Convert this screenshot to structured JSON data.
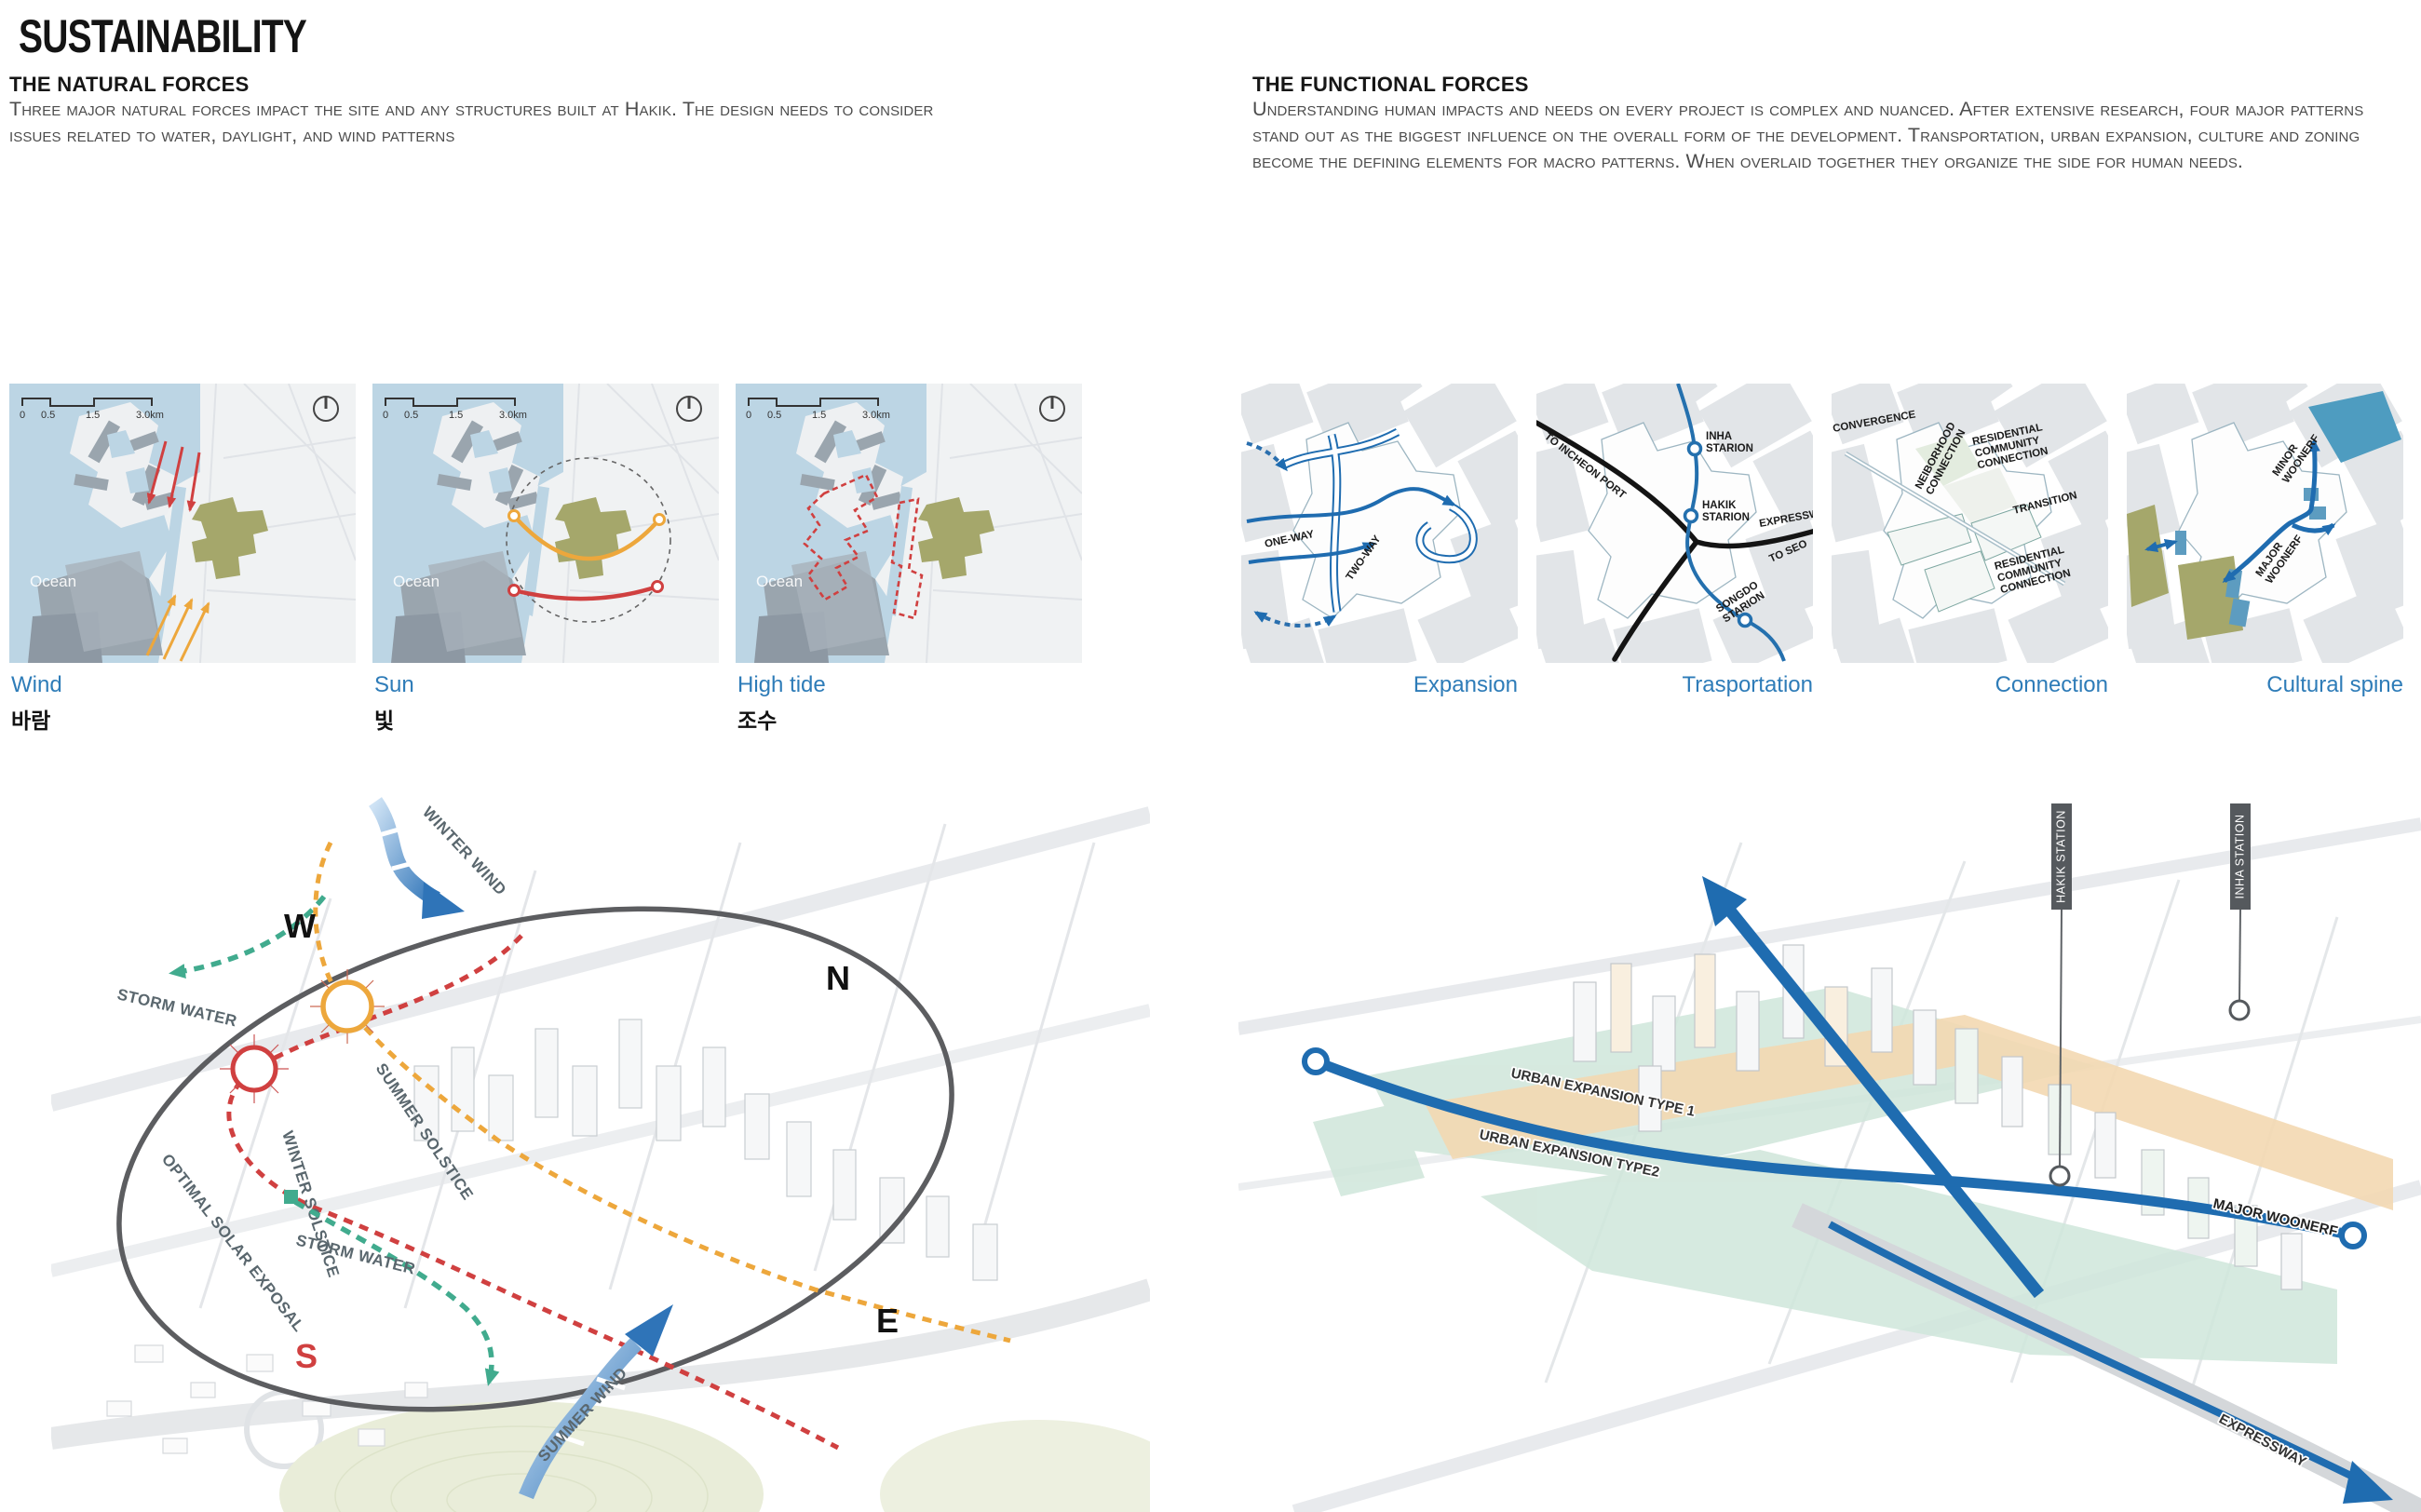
{
  "page": {
    "title": "SUSTAINABILITY"
  },
  "colors": {
    "accent_blue": "#2e7cb8",
    "line_blue": "#1f6cb0",
    "red": "#d04040",
    "orange": "#eda73c",
    "teal": "#41ab8e",
    "olive": "#a5a76b",
    "ocean_blue": "#bcd5e4",
    "flag_gray": "#55595d"
  },
  "natural_forces": {
    "heading": "THE NATURAL FORCES",
    "body": "Three major natural forces impact the site and any structures built at Hakik. The design needs to consider issues related to water, daylight, and wind patterns",
    "map_chrome": {
      "scale_ticks": [
        "0",
        "0.5",
        "1.5",
        "3.0km"
      ],
      "ocean_label": "Ocean"
    },
    "maps": [
      {
        "label_en": "Wind",
        "label_kr": "바람"
      },
      {
        "label_en": "Sun",
        "label_kr": "빛"
      },
      {
        "label_en": "High tide",
        "label_kr": "조수"
      }
    ],
    "site_diagram": {
      "compass": {
        "w": "W",
        "n": "N",
        "s": "S",
        "e": "E"
      },
      "labels": {
        "winter_wind": "WINTER WIND",
        "storm_water_top": "STORM WATER",
        "storm_water_bottom": "STORM WATER",
        "summer_solstice": "SUMMER SOLSTICE",
        "winter_solstice": "WINTER SOLSTICE",
        "optimal_solar": "OPTIMAL SOLAR EXPOSAL",
        "summer_wind": "SUMMER WIND"
      }
    }
  },
  "functional_forces": {
    "heading": "THE FUNCTIONAL FORCES",
    "body": "Understanding human impacts and needs on every project is complex and nuanced. After extensive research, four major patterns stand out as the biggest influence on the overall form of the development. Transportation, urban expansion, culture and zoning become the defining elements for macro patterns. When overlaid together they organize the side for human needs.",
    "maps": [
      {
        "label": "Expansion",
        "annotations": {
          "one_way": "ONE-WAY",
          "two_way": "TWO-WAY"
        }
      },
      {
        "label": "Trasportation",
        "annotations": {
          "to_incheon": "TO INCHEON PORT",
          "inha_1": "INHA",
          "inha_2": "STARION",
          "hakik_1": "HAKIK",
          "hakik_2": "STARION",
          "expressway": "EXPRESSW",
          "to_seoul": "TO SEO",
          "songdo_1": "SONGDO",
          "songdo_2": "STARION"
        }
      },
      {
        "label": "Connection",
        "annotations": {
          "convergence": "CONVERGENCE",
          "neighborhood_1": "NEIBORHOOD",
          "neighborhood_2": "CONNECTION",
          "res1_1": "RESIDENTIAL",
          "res1_2": "COMMUNITY",
          "res1_3": "CONNECTION",
          "transition": "TRANSITION",
          "res2_1": "RESIDENTIAL",
          "res2_2": "COMMUNITY",
          "res2_3": "CONNECTION"
        }
      },
      {
        "label": "Cultural spine",
        "annotations": {
          "minor_1": "MINOR",
          "minor_2": "WOONERF",
          "major_1": "MAJOR",
          "major_2": "WOONERF"
        }
      }
    ],
    "site_diagram": {
      "labels": {
        "hakik_station": "HAKIK STATION",
        "inha_station": "INHA STATION",
        "urban_expansion_1": "URBAN EXPANSION TYPE 1",
        "urban_expansion_2": "URBAN EXPANSION TYPE2",
        "major_woonerf": "MAJOR WOONERF",
        "expressway": "EXPRESSWAY"
      }
    }
  }
}
